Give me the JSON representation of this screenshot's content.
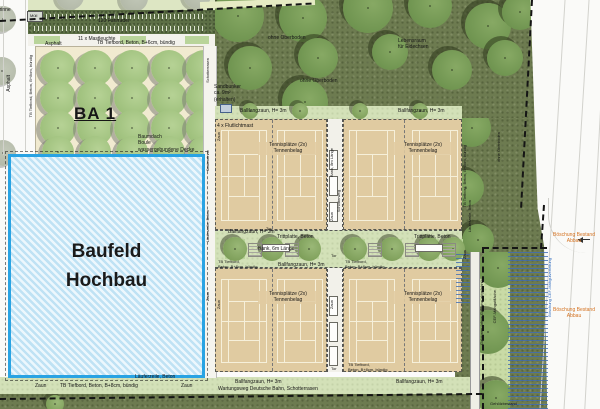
{
  "labels": {
    "ba1": "BA 1",
    "baufeld_line1": "Baufeld",
    "baufeld_line2": "Hochbau",
    "fahrraeder": "120 Fahrräder",
    "mastleuchte": "11 x Mastleuchte",
    "muell": "Müll",
    "asphalt": "Asphalt",
    "tiefbord6": "TB Tiefbord, Beton, B+6cm, bündig",
    "tiefbord8": "TB Tiefbord, Beton, B+8cm, bündig",
    "tiefbord8_l1": "TB Tiefbord,",
    "tiefbord8_l2": "Beton, B+8cm, bündig",
    "baumdach_1": "Baumdach",
    "baumdach_2": "Boule",
    "baumdach_3": "wassergebundene Decke",
    "kastenrinne": "Kastenrinne",
    "laeuferzeile": "Läuferzeile, Beton",
    "schotterrasen": "Schotterrasen",
    "zaun": "Zaun",
    "tor": "Tor",
    "ballfangzaun": "Ballfangzaun, H= 3m",
    "flutlichtmast": "4 x Flutlichtmast",
    "tennisplaetze": "Tennisplätze (2x)",
    "tennenbelag": "Tennenbelag",
    "bank6": "Bank, 6m Länge",
    "bank8": "Bank, 8m Länge",
    "schotterweg": "Schotterweg",
    "trittplatte": "Trittplatte, Beton",
    "wartungsweg": "Wartungsweg Deutsche Bahn, Schotterrasen",
    "ohne_oberboden": "ohne Oberboden",
    "eidechsen_1": "Lebensraum",
    "eidechsen_2": "für Eidechsen",
    "sandbunker_1": "Sandbunker",
    "sandbunker_2": "ca. 9m²",
    "sandbunker_3": "(erhalten)",
    "boeschung_1": "Böschung Bestand",
    "boeschung_2": "Abbau",
    "boeschung_cef": "Böschung CEF-Mähgutverteilung",
    "cef": "CEF-Mähgutfläche",
    "gabionen": "Gabionen (ohne Gabione abgelehnt)",
    "gehoelzbestand": "Gehölzbestand"
  },
  "colors": {
    "baufeld_border": "#29a3e3",
    "baufeld_fill": "#cfeaf8",
    "court": "#e0cba1",
    "forest": "#6d7b50",
    "lawn": "#d3e1b8",
    "boeschung_text": "#d4711f",
    "hatch_blue": "#3e6cb6"
  }
}
